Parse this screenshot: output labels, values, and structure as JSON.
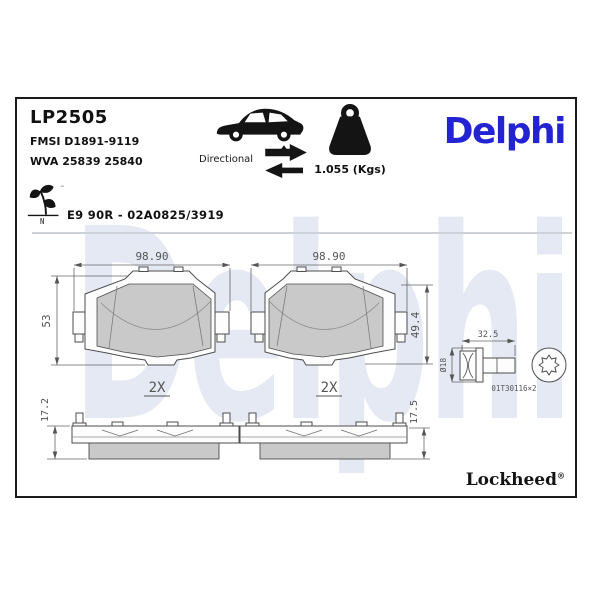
{
  "header": {
    "part_number": "LP2505",
    "fmsi": "FMSI D1891-9119",
    "wva": "WVA 25839 25840",
    "directional_label": "Directional",
    "weight_label": "1.055 (Kgs)",
    "brand_logo": "Delphi",
    "approval_code": "E9 90R - 02A0825/3919",
    "eco_mark_letter": "N",
    "eco_mark_tm": "™"
  },
  "watermark_text": "Delphi",
  "drawing": {
    "front_left": {
      "width": "98.90",
      "height": "53",
      "qty": "2X"
    },
    "front_right": {
      "width": "98.90",
      "height": "49.4",
      "qty": "2X"
    },
    "profile_left": {
      "thickness": "17.2"
    },
    "profile_right": {
      "thickness": "17.5"
    },
    "bolt": {
      "length": "32.5",
      "diameter": "Ø18",
      "ref": "01T30116×2"
    }
  },
  "footer": {
    "brand_logo": "Lockheed",
    "registered_mark": "®"
  },
  "colors": {
    "brand_blue": "#2323d3",
    "watermark_blue": "#e4e9f3",
    "pad_fill": "#c9c9c9",
    "line": "#4d4d4d"
  }
}
